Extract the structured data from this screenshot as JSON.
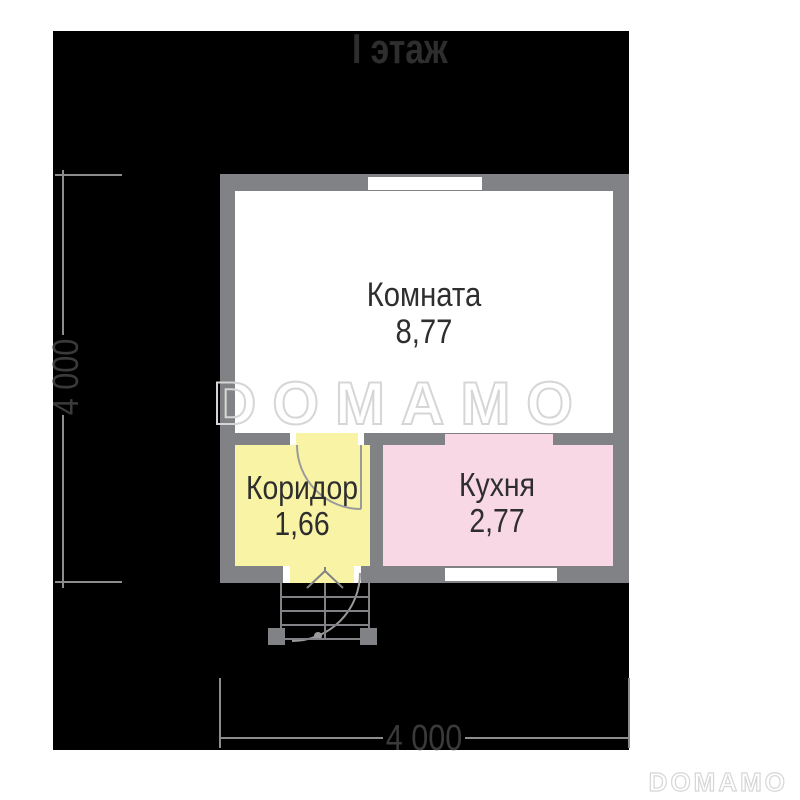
{
  "title": "I этаж",
  "plan": {
    "rooms": [
      {
        "name": "Комната",
        "area": "8,77"
      },
      {
        "name": "Коридор",
        "area": "1,66"
      },
      {
        "name": "Кухня",
        "area": "2,77"
      }
    ]
  },
  "dimensions": {
    "left": "4 000",
    "bottom": "4 000"
  },
  "watermarks": {
    "large": "DOMAMO",
    "corner": "DOMAMO"
  },
  "colors": {
    "mask": "#000000",
    "wall": "#808285",
    "room": "#ffffff",
    "corridor": "#f9f3a5",
    "kitchen": "#f8d8e4",
    "title_text": "#2e2e2e",
    "label_text": "#2e2e2e",
    "dim_line": "#8c8c8c",
    "dim_text": "#3a3a3a",
    "door_line": "#9a9a9a",
    "porch_line": "#808285",
    "watermark": "#d6d6d6"
  }
}
